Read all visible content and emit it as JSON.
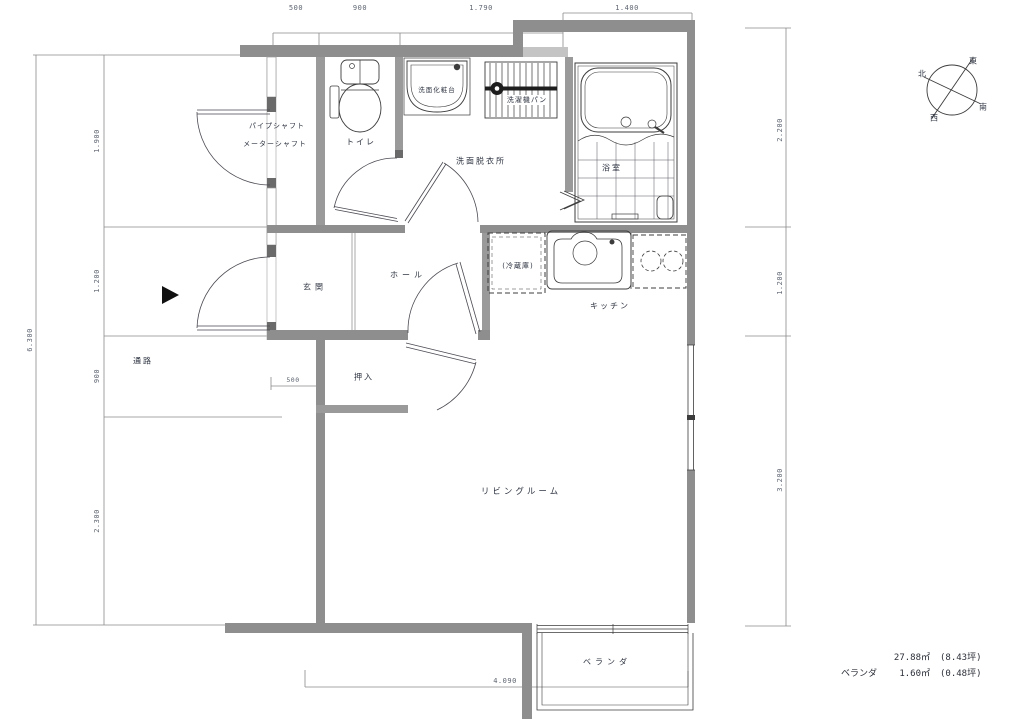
{
  "floorplan": {
    "rooms": {
      "pipe_shaft": "パイプシャフト",
      "meter_shaft": "メーターシャフト",
      "toilet": "トイレ",
      "vanity": "洗面化粧台",
      "washer_pan": "洗濯機パン",
      "washroom": "洗面脱衣所",
      "bathroom": "浴室",
      "fridge": "(冷蔵庫)",
      "kitchen": "キッチン",
      "entrance": "玄関",
      "hall": "ホール",
      "closet": "押入",
      "living": "リビングルーム",
      "veranda": "ベランダ",
      "passage": "通路"
    },
    "dimensions": {
      "top": [
        "500",
        "900",
        "1.790",
        "1.400"
      ],
      "left": [
        "1.900",
        "1.200",
        "900",
        "2.300"
      ],
      "left_outer": "6.300",
      "right": [
        "2.200",
        "1.200",
        "3.200"
      ],
      "bottom": "4.090",
      "entrance_step": "500"
    },
    "compass": {
      "north": "北",
      "east": "東",
      "south": "南",
      "west": "西"
    },
    "area": {
      "main_value": "27.88㎡",
      "main_tsubo": "(8.43坪)",
      "veranda_label": "ベランダ",
      "veranda_value": "1.60㎡",
      "veranda_tsubo": "(0.48坪)"
    },
    "colors": {
      "wall": "#8e8e8e",
      "wall_light": "#c4c4c4",
      "wall_dark": "#6a6a6a",
      "line": "#3c3c3c",
      "dim_line": "#8a8a8a"
    }
  }
}
